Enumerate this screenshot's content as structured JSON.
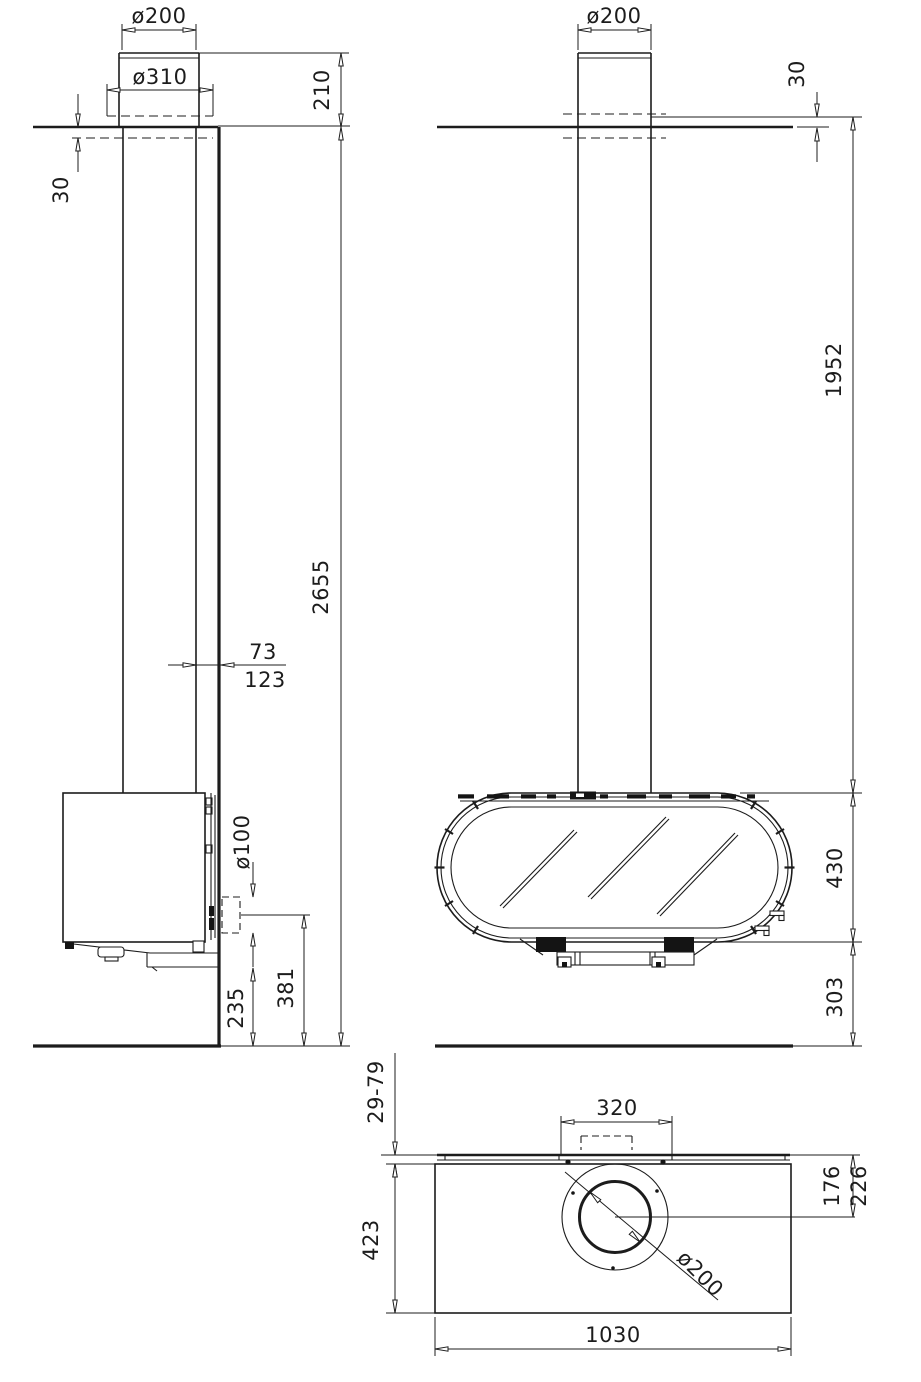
{
  "meta": {
    "type": "technical-dimension-drawing",
    "subject": "wall-mounted stove with ceiling flue pipe, three orthographic views",
    "line_color": "#1c1c1c",
    "background_color": "#ffffff",
    "units": "mm"
  },
  "side": {
    "flue_diameter": "ø200",
    "cover_plate_diameter": "ø310",
    "pipe_above_ceiling": "210",
    "plate_drop": "30",
    "ceiling_height": "2655",
    "pipe_to_wall_min": "73",
    "pipe_to_wall_max": "123",
    "rear_outlet_diameter": "ø100",
    "outlet_center_height": "381",
    "underside_height": "235"
  },
  "front": {
    "flue_diameter": "ø200",
    "plate_drop": "30",
    "ceiling_to_body_top": "1952",
    "body_height": "430",
    "clearance_below": "303"
  },
  "top": {
    "wall_gap_range": "29-79",
    "bracket_width": "320",
    "body_depth": "423",
    "center_to_wall_min": "176",
    "center_to_wall_max": "226",
    "body_width": "1030",
    "flue_diameter": "ø200"
  }
}
